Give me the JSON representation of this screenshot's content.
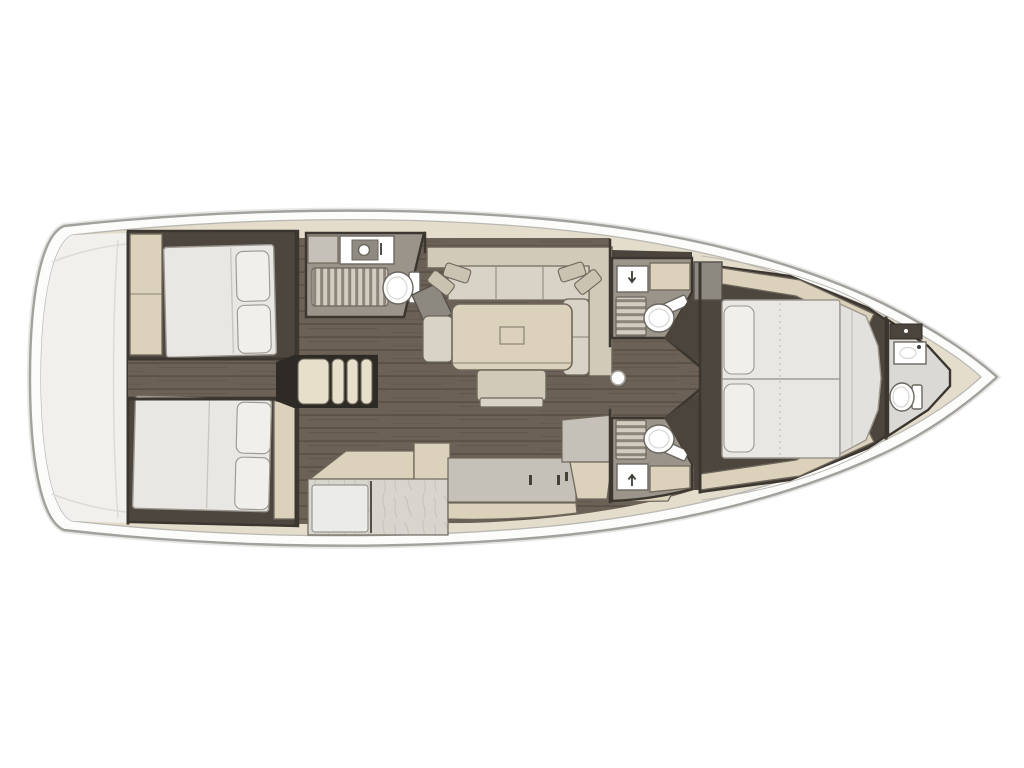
{
  "palette": {
    "background": "#ffffff",
    "hull_outline": "#a3a19c",
    "hull_inner_line": "#bab8b3",
    "deck": "#e4ddcb",
    "transom": "#f1f0ed",
    "wall": "#3b362f",
    "floor_wood": "#6c6156",
    "floor_wood_streak": "#574d43",
    "cabin_floor": "#4d463f",
    "head_floor": "#9a948a",
    "furniture_cream": "#dcd1ba",
    "furniture_outline": "#6e685c",
    "cushion_seat": "#d8d3c6",
    "cushion_back": "#d1cab9",
    "pillow_sofa": "#cac3b1",
    "mattress": "#e8e7e3",
    "mattress_outline": "#9c978f",
    "mattress_seam": "#c9c5be",
    "pillow": "#f0efec",
    "marble": "#d8d5cf",
    "marble_vein": "#b4b1ab",
    "counter_gray": "#c5c1b8",
    "grate_bg": "#8b8679",
    "grate_bar": "#d2cdc0",
    "fixture_white": "#ffffff",
    "fixture_outline": "#6b675f",
    "dark_wedge": "#4a443c",
    "steps_cream": "#e7dfca",
    "steps_dark": "#2e2a25",
    "gray_block": "#8d8880"
  },
  "diagram": {
    "type": "floorplan",
    "subject": "sailing-yacht interior layout, top view",
    "orientation": {
      "bow": "right",
      "stern": "left"
    },
    "rooms": [
      {
        "id": "swim-platform",
        "name": "Stern transom and swim platform",
        "fixtures": []
      },
      {
        "id": "aft-cabin-port",
        "name": "Aft double cabin (top/port)",
        "fixtures": [
          "double-berth",
          "pillows",
          "wardrobe"
        ]
      },
      {
        "id": "aft-cabin-starboard",
        "name": "Aft double cabin (bottom/starboard)",
        "fixtures": [
          "double-berth",
          "pillows",
          "side-locker"
        ]
      },
      {
        "id": "companionway-steps",
        "name": "Companionway steps",
        "fixtures": [
          "steps"
        ]
      },
      {
        "id": "aft-head",
        "name": "Aft head with shower",
        "fixtures": [
          "sink",
          "shower-grate",
          "toilet"
        ]
      },
      {
        "id": "saloon",
        "name": "Saloon",
        "fixtures": [
          "l-shaped-sofa",
          "scatter-cushions",
          "dining-table",
          "bench-seat"
        ]
      },
      {
        "id": "galley",
        "name": "Galley",
        "fixtures": [
          "worktop",
          "sink-counter",
          "refrigerator",
          "drawers"
        ]
      },
      {
        "id": "mid-head-port",
        "name": "Forward head (top/port)",
        "fixtures": [
          "sink",
          "shower-grate",
          "toilet",
          "locker"
        ]
      },
      {
        "id": "mid-head-starboard",
        "name": "Forward head (bottom/starboard)",
        "fixtures": [
          "sink",
          "shower-grate",
          "toilet",
          "locker"
        ]
      },
      {
        "id": "forward-cabin",
        "name": "Forward owner's cabin",
        "fixtures": [
          "island-double-berth",
          "pillows",
          "side-lockers"
        ]
      },
      {
        "id": "bow-head",
        "name": "Bow compartment",
        "fixtures": [
          "sink",
          "toilet",
          "shelf"
        ]
      },
      {
        "id": "mast",
        "name": "Mast position",
        "fixtures": [
          "mast-step"
        ]
      }
    ]
  }
}
